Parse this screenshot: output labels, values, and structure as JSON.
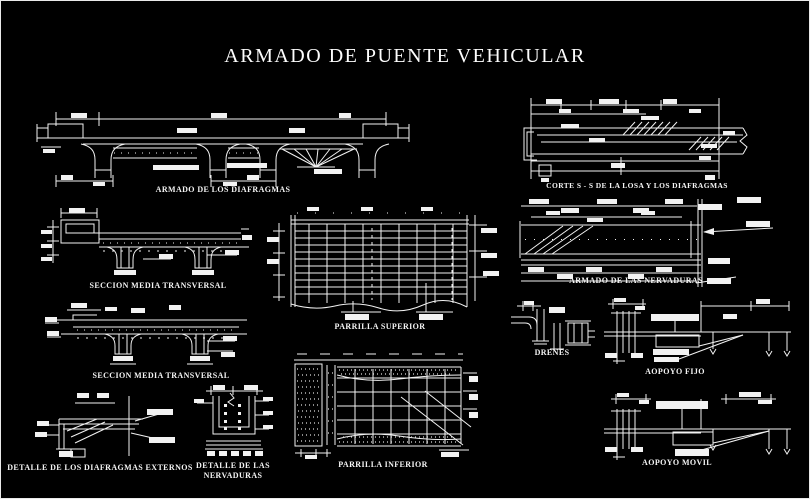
{
  "title": "ARMADO DE PUENTE VEHICULAR",
  "colors": {
    "background": "#000000",
    "line": "#ffffff",
    "text": "#f4f4f4"
  },
  "labels": {
    "armado_diafragmas": "ARMADO DE LOS DIAFRAGMAS",
    "corte_ss": "CORTE S - S DE LA LOSA Y LOS DIAFRAGMAS",
    "seccion_media_1": "SECCION MEDIA TRANSVERSAL",
    "seccion_media_2": "SECCION MEDIA TRANSVERSAL",
    "parrilla_superior": "PARRILLA SUPERIOR",
    "parrilla_inferior": "PARRILLA INFERIOR",
    "armado_nervaduras": "ARMADO DE LAS NERVADURAS",
    "drenes": "DRENES",
    "apoyo_fijo": "AOPOYO FIJO",
    "apoyo_movil": "AOPOYO MOVIL",
    "detalle_diafragmas_externos": "DETALLE DE LOS DIAFRAGMAS EXTERNOS",
    "detalle_nervaduras_line1": "DETALLE DE LAS",
    "detalle_nervaduras_line2": "NERVADURAS"
  }
}
